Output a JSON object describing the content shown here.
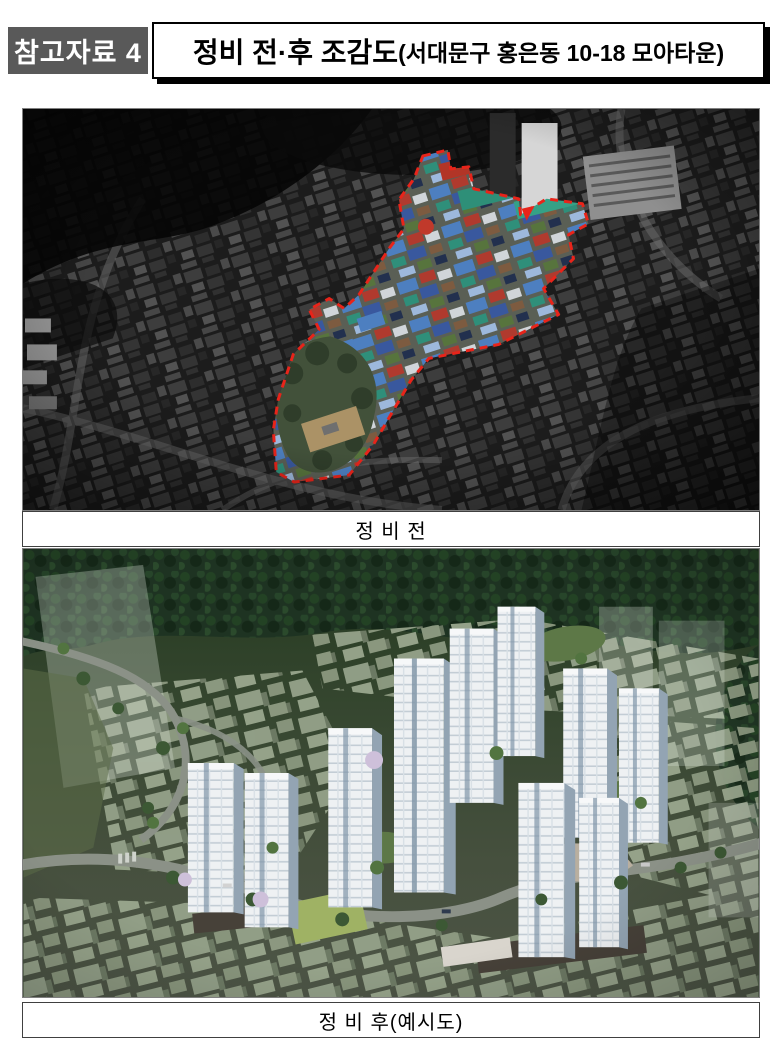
{
  "header": {
    "badge_label": "참고자료 4",
    "title_main": "정비 전·후 조감도",
    "title_sub": "(서대문구 홍은동 10-18 모아타운)"
  },
  "figures": {
    "before": {
      "caption": "정 비 전"
    },
    "after": {
      "caption": "정 비 후(예시도)"
    }
  },
  "colors": {
    "badge_bg": "#595959",
    "badge_text": "#ffffff",
    "title_border": "#000000",
    "boundary_dash_red": "#e8241a",
    "page_bg": "#ffffff"
  }
}
